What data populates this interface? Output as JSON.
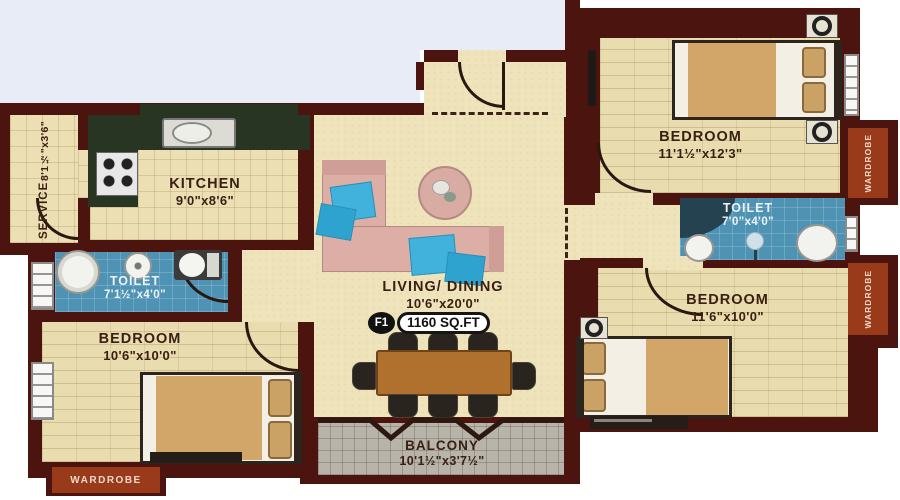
{
  "plan": {
    "badge": {
      "unit_label": "F1",
      "area_label": "1160 SQ.FT"
    },
    "rooms": {
      "service": {
        "name": "SERVICE",
        "dims": "8'1½\"x3'6\""
      },
      "kitchen": {
        "name": "KITCHEN",
        "dims": "9'0\"x8'6\""
      },
      "toilet_left": {
        "name": "TOILET",
        "dims": "7'1½\"x4'0\""
      },
      "bedroom_left": {
        "name": "BEDROOM",
        "dims": "10'6\"x10'0\""
      },
      "living_dining": {
        "name": "LIVING/ DINING",
        "dims": "10'6\"x20'0\""
      },
      "balcony": {
        "name": "BALCONY",
        "dims": "10'1½\"x3'7½\""
      },
      "bedroom_top_right": {
        "name": "BEDROOM",
        "dims": "11'1½\"x12'3\""
      },
      "toilet_right": {
        "name": "TOILET",
        "dims": "7'0\"x4'0\""
      },
      "bedroom_bottom_right": {
        "name": "BEDROOM",
        "dims": "11'6\"x10'0\""
      }
    },
    "wardrobes": {
      "left_bottom": "WARDROBE",
      "right_top": "WARDROBE",
      "right_middle": "WARDROBE"
    },
    "colors": {
      "wall": "#4b140e",
      "floor": "#ecdfb3",
      "toilet": "#4e92b4",
      "balcony": "#b8b4a9",
      "wardrobe": "#993a1b",
      "counter": "#283522",
      "label_text": "#3a2013",
      "accent_blue_cushion": "#41b2dc"
    }
  }
}
